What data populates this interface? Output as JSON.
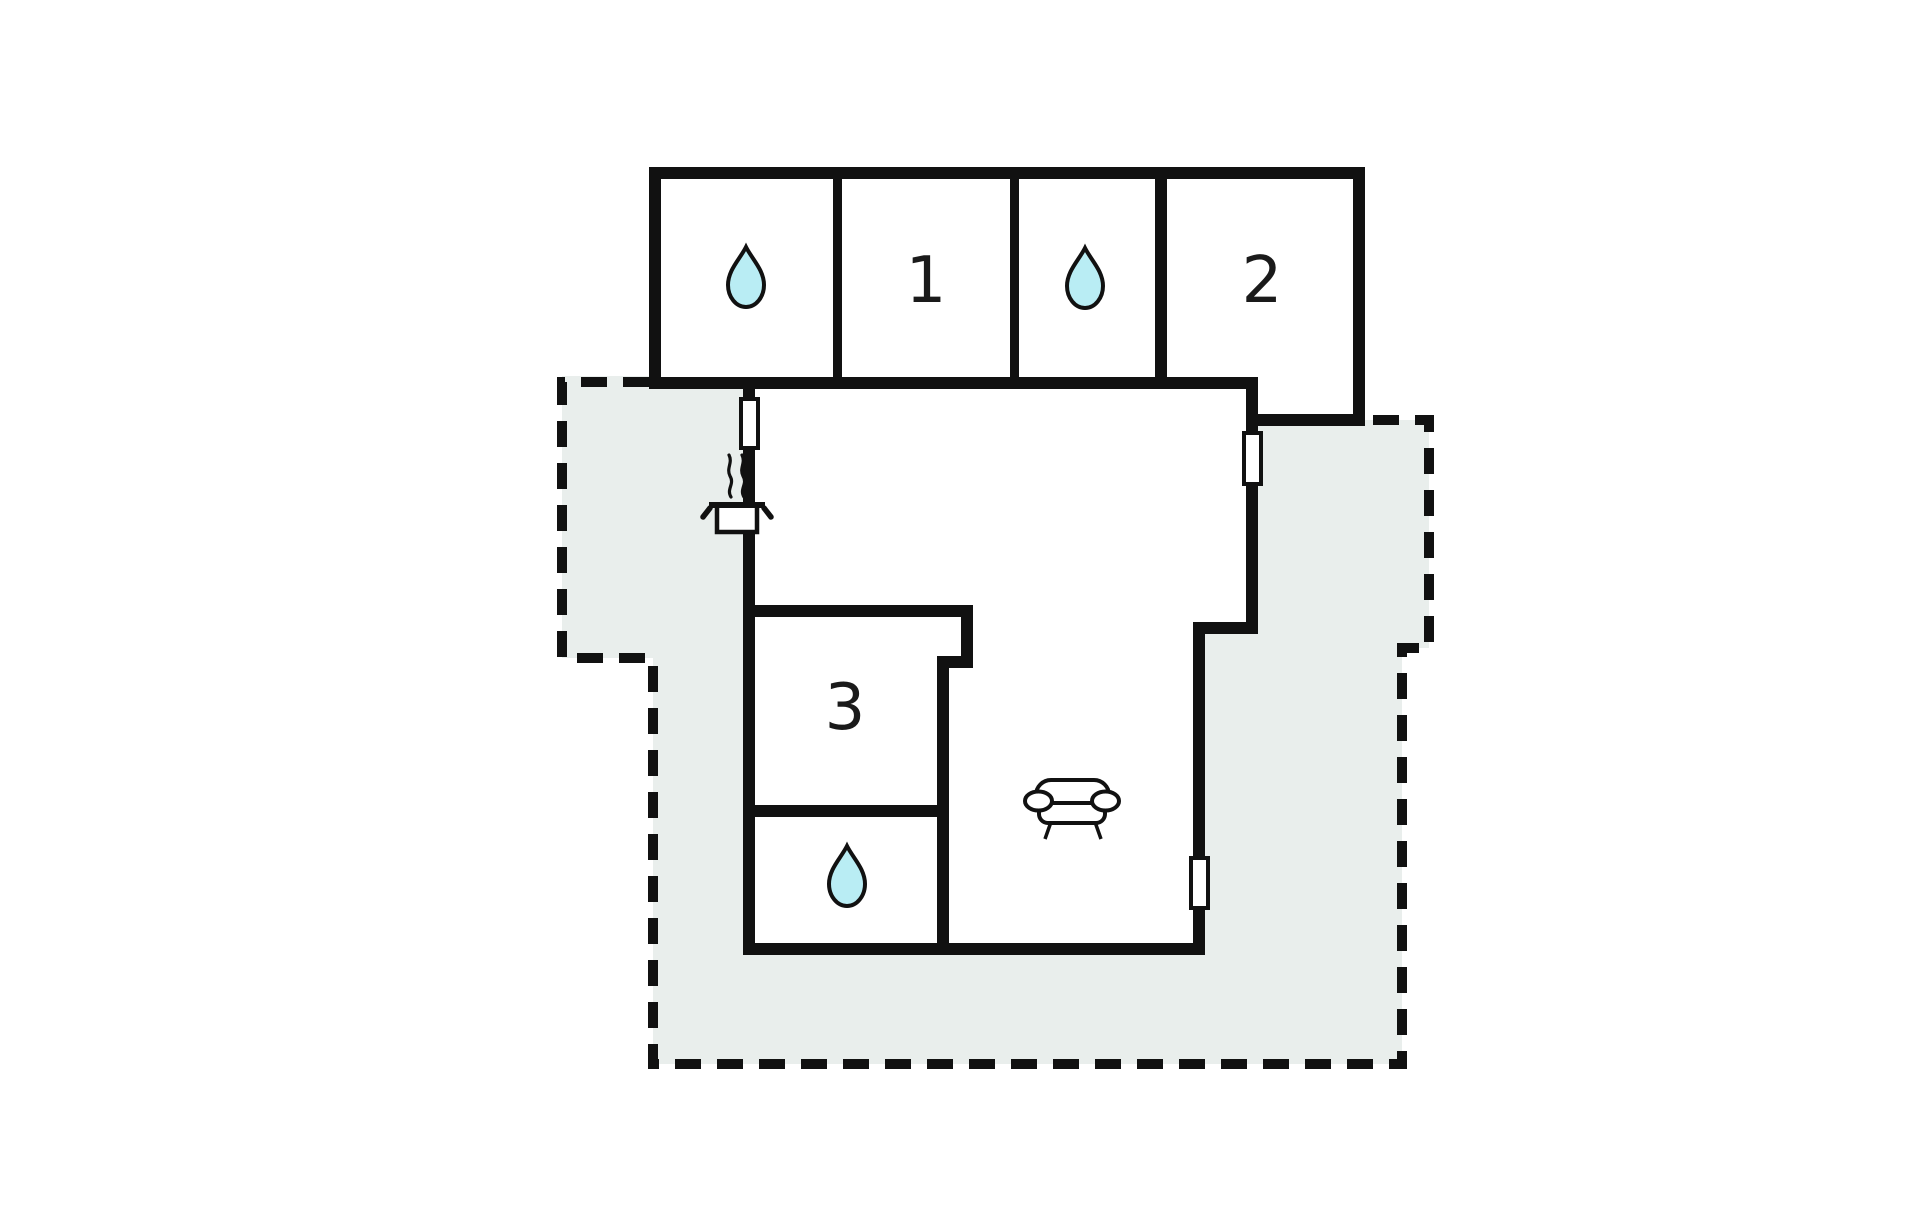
{
  "diagram": {
    "type": "floor-plan",
    "canvas": {
      "width": 1920,
      "height": 1221
    },
    "colors": {
      "background": "#ffffff",
      "wall": "#111111",
      "room_fill": "#ffffff",
      "terrace_fill": "#e9eeec",
      "dashed_line": "#111111",
      "door_fill": "#ffffff",
      "droplet_fill": "#b9edf4",
      "icon_stroke": "#111111",
      "label_color": "#1a1a1a"
    },
    "terrace": {
      "fill_points": "562,376 655,376 655,383 1360,383 1360,420 1429,420 1429,648 1402,648 1402,1064 653,1064 653,658 562,658",
      "dashed_path": "M 649 382 L 562 382 L 562 658 L 653 658 L 653 1064 L 1402 1064 L 1402 648 L 1429 648 L 1429 420 L 1367 420",
      "dash_pattern": "26 16",
      "dash_width": 10
    },
    "building_fills": [
      {
        "name": "bedroom-wing",
        "points": "649,167 1365,167 1365,426 1246,426 1246,389 649,389"
      },
      {
        "name": "main-living-area",
        "points": "743,377 1258,377 1258,634 1205,634 1205,955 743,955"
      }
    ],
    "walls": [
      {
        "name": "wing-top-wall",
        "x": 649,
        "y": 167,
        "w": 716,
        "h": 12
      },
      {
        "name": "wing-left-wall",
        "x": 649,
        "y": 167,
        "w": 12,
        "h": 222
      },
      {
        "name": "wing-right-wall",
        "x": 1353,
        "y": 167,
        "w": 12,
        "h": 259
      },
      {
        "name": "wing-bottom-wall",
        "x": 649,
        "y": 377,
        "w": 609,
        "h": 12
      },
      {
        "name": "wing-step-wall",
        "x": 1246,
        "y": 377,
        "w": 12,
        "h": 49
      },
      {
        "name": "bedroom-2-bottom-wall",
        "x": 1246,
        "y": 414,
        "w": 119,
        "h": 12
      },
      {
        "name": "divider-bath1-bed1",
        "x": 833,
        "y": 179,
        "w": 9,
        "h": 198
      },
      {
        "name": "divider-bed1-bath2",
        "x": 1010,
        "y": 179,
        "w": 9,
        "h": 198
      },
      {
        "name": "divider-bath2-bed2",
        "x": 1155,
        "y": 179,
        "w": 12,
        "h": 198
      },
      {
        "name": "main-left-wall",
        "x": 743,
        "y": 377,
        "w": 12,
        "h": 578
      },
      {
        "name": "main-bottom-wall",
        "x": 743,
        "y": 943,
        "w": 462,
        "h": 12
      },
      {
        "name": "main-right-lower-wall",
        "x": 1193,
        "y": 628,
        "w": 12,
        "h": 327
      },
      {
        "name": "main-right-jog-wall",
        "x": 1193,
        "y": 622,
        "w": 65,
        "h": 12
      },
      {
        "name": "main-right-upper-wall",
        "x": 1246,
        "y": 420,
        "w": 12,
        "h": 214
      },
      {
        "name": "bedroom-3-top-wall",
        "x": 743,
        "y": 605,
        "w": 230,
        "h": 12
      },
      {
        "name": "bedroom-3-right-upper",
        "x": 961,
        "y": 605,
        "w": 12,
        "h": 63
      },
      {
        "name": "bedroom-3-notch-wall",
        "x": 941,
        "y": 656,
        "w": 32,
        "h": 12
      },
      {
        "name": "bedroom-3-right-lower",
        "x": 937,
        "y": 656,
        "w": 12,
        "h": 299
      },
      {
        "name": "divider-bed3-bath3",
        "x": 743,
        "y": 805,
        "w": 206,
        "h": 12
      }
    ],
    "doors": [
      {
        "name": "door-window-left",
        "x": 741,
        "y": 399,
        "w": 17,
        "h": 49
      },
      {
        "name": "door-window-right-upper",
        "x": 1244,
        "y": 433,
        "w": 17,
        "h": 51
      },
      {
        "name": "door-window-right-lower",
        "x": 1191,
        "y": 858,
        "w": 17,
        "h": 50
      }
    ],
    "rooms": [
      {
        "id": "bathroom-1",
        "label": "",
        "icon": "water-drop",
        "cx": 746,
        "cy": 277
      },
      {
        "id": "bedroom-1",
        "label": "1",
        "icon": "",
        "cx": 926,
        "cy": 281
      },
      {
        "id": "bathroom-2",
        "label": "",
        "icon": "water-drop",
        "cx": 1085,
        "cy": 278
      },
      {
        "id": "bedroom-2",
        "label": "2",
        "icon": "",
        "cx": 1262,
        "cy": 281
      },
      {
        "id": "bedroom-3",
        "label": "3",
        "icon": "",
        "cx": 845,
        "cy": 708
      },
      {
        "id": "bathroom-3",
        "label": "",
        "icon": "water-drop",
        "cx": 847,
        "cy": 876
      },
      {
        "id": "kitchen",
        "label": "",
        "icon": "cooking-pot",
        "cx": 737,
        "cy": 516
      },
      {
        "id": "living-room",
        "label": "",
        "icon": "sofa",
        "cx": 1072,
        "cy": 806
      }
    ],
    "label_font_size": 64
  }
}
